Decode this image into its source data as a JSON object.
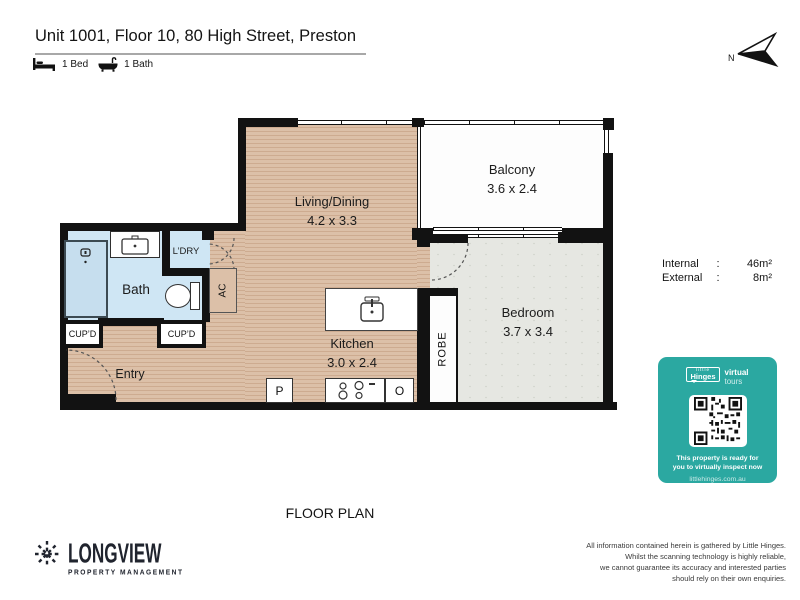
{
  "header": {
    "title": "Unit 1001, Floor 10, 80 High Street, Preston",
    "bed_label": "1 Bed",
    "bath_label": "1 Bath",
    "compass_label": "N"
  },
  "plan": {
    "rooms": {
      "living": {
        "name": "Living/Dining",
        "dims": "4.2 x 3.3"
      },
      "balcony": {
        "name": "Balcony",
        "dims": "3.6 x 2.4"
      },
      "bedroom": {
        "name": "Bedroom",
        "dims": "3.7 x 3.4"
      },
      "kitchen": {
        "name": "Kitchen",
        "dims": "3.0 x 2.4"
      },
      "bath": {
        "name": "Bath"
      },
      "entry": {
        "name": "Entry"
      }
    },
    "features": {
      "laundry": "L’DRY",
      "ac": "AC",
      "robe": "ROBE",
      "cupboard_left": "CUP’D",
      "cupboard_right": "CUP’D",
      "pantry": "P",
      "oven": "O"
    }
  },
  "areas": {
    "internal_label": "Internal",
    "internal_value": "46m²",
    "external_label": "External",
    "external_value": "8m²",
    "colon": ":"
  },
  "badge": {
    "brand_top": "little",
    "brand": "Hinges",
    "tag_line1": "virtual",
    "tag_line2": "tours",
    "message": [
      "This property is ready for",
      "you to virtually inspect now"
    ],
    "url": "littlehinges.com.au",
    "teal_color": "#2BA8A1"
  },
  "footer": {
    "plan_caption": "FLOOR PLAN",
    "brand": "LONGVIEW",
    "brand_sub": "PROPERTY MANAGEMENT",
    "disclaimer": [
      "All information contained herein is gathered by Little Hinges.",
      "Whilst the scanning technology is highly reliable,",
      "we cannot guarantee its accuracy and interested parties",
      "should rely on their own enquiries."
    ]
  },
  "colors": {
    "wall": "#121212",
    "wood_floor": "#D8BA9F",
    "bath_blue": "#CFE6F4",
    "carpet": "#E6E7E2"
  }
}
